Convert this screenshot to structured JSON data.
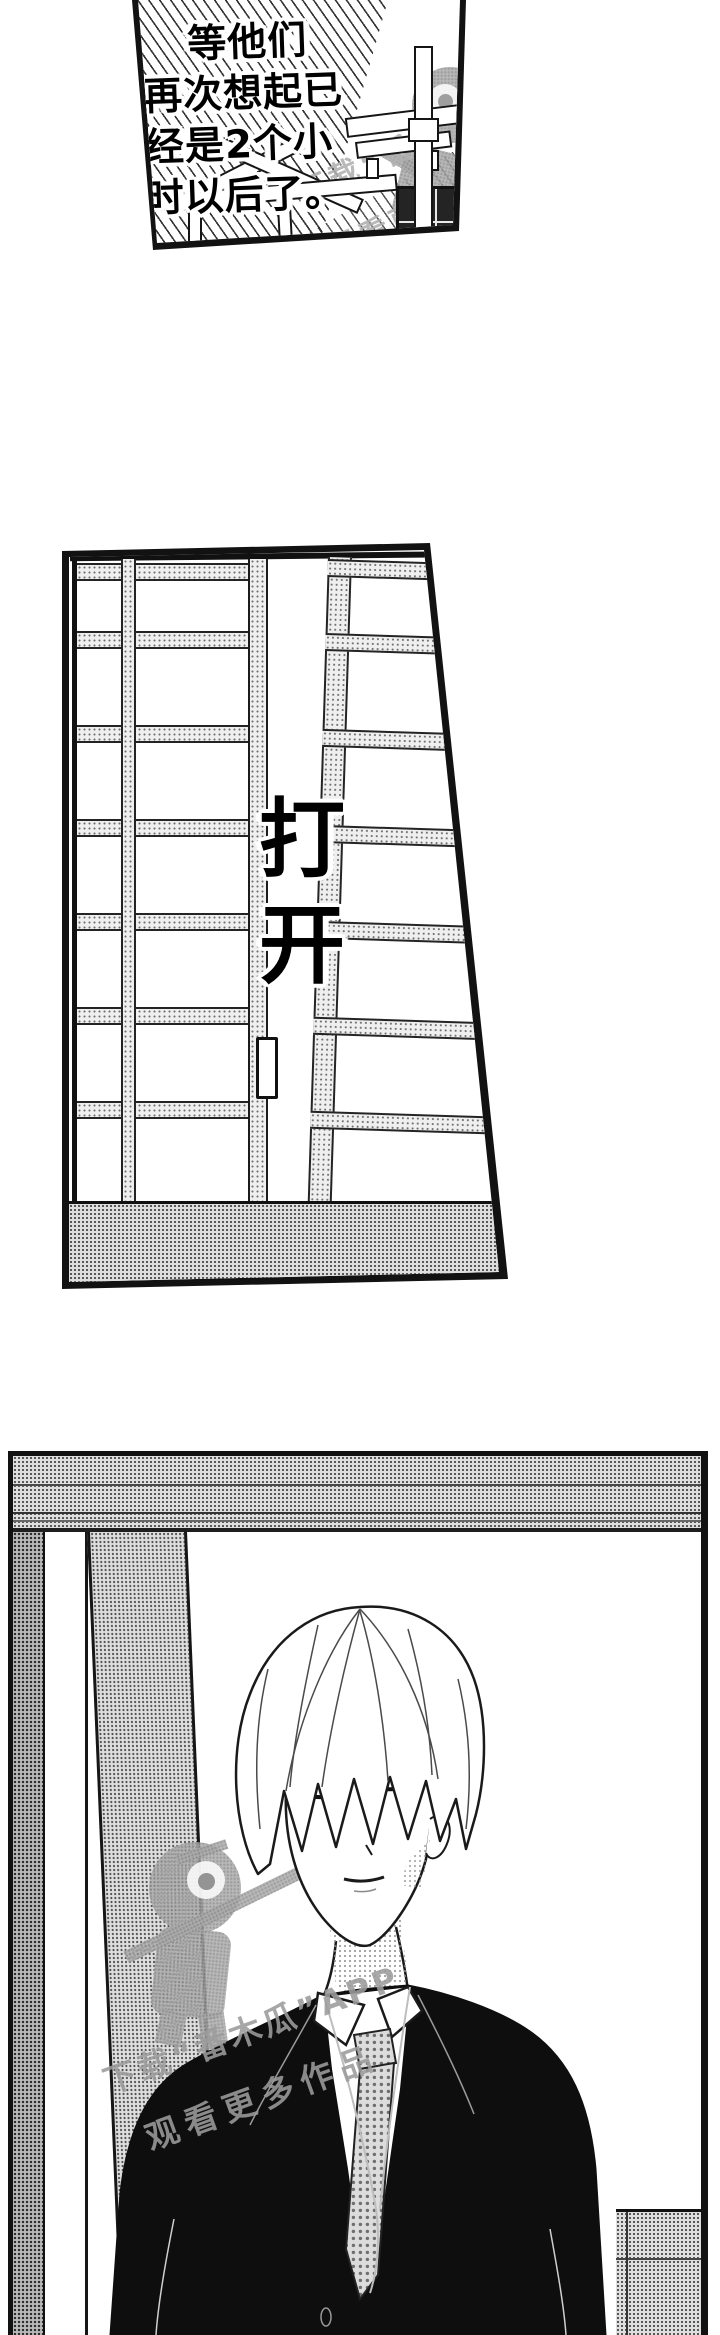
{
  "page": {
    "kind": "manga page",
    "background": "#ffffff"
  },
  "panel1": {
    "caption_lines": [
      "等他们",
      "再次想起已",
      "经是2个小",
      "时以后了。"
    ]
  },
  "panel2": {
    "sfx_text": "打开",
    "sfx_chars": [
      "打",
      "开"
    ]
  },
  "watermark": {
    "line1": "下载“番木瓜”APP",
    "line2": "观看更多作品",
    "app_name": "番木瓜",
    "mascot": "papaya-character"
  },
  "colors": {
    "ink": "#1a1a1a",
    "paper": "#ffffff",
    "halftone_gray": "#a6a6a6",
    "suit_black": "#0e0e0e"
  }
}
